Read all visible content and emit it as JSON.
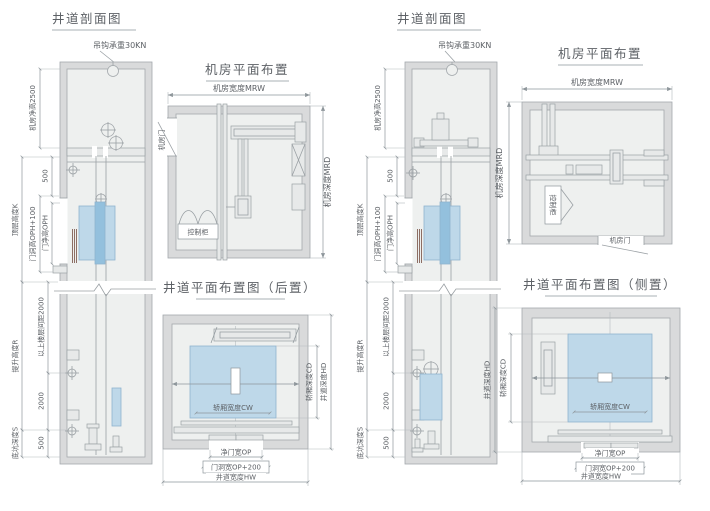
{
  "colors": {
    "line": "#9aa0a4",
    "wall_fill": "#d9dadb",
    "inner_fill": "#eef0ef",
    "car_fill": "#bed8e9",
    "car_band": "#93c0dd",
    "text": "#5d6166",
    "door_stripe": "#8d6e64"
  },
  "panels": {
    "section_left": {
      "title": "井道剖面图",
      "hook_label": "吊钩承重30KN",
      "machine_room_clear_height": "机房净高2500",
      "dim_500_top": "500",
      "door_opening_height": "门洞高OPH+100",
      "door_clear_height": "门净高OPH",
      "top_floor_height": "顶层高度K",
      "travel_height": "提升高度R",
      "upper_floor_spacing": "以上楼层间距2000",
      "dim_2000": "2000",
      "dim_500_bottom": "500",
      "pit_depth": "底坑深度S"
    },
    "machine_plan_left": {
      "title": "机房平面布置",
      "machine_room_width": "机房宽度MRW",
      "machine_room_depth": "机房深度MRD",
      "machine_room_door": "机房门",
      "control_cabinet": "控制柜"
    },
    "shaft_plan_rear": {
      "title": "井道平面布置图（后置）",
      "car_width": "轿厢宽度CW",
      "car_depth": "轿厢深度CD",
      "shaft_depth": "井道深度HD",
      "door_clear_width": "净门宽OP",
      "door_opening_width": "门洞宽OP+200",
      "shaft_width": "井道宽度HW"
    },
    "section_right": {
      "title": "井道剖面图",
      "hook_label": "吊钩承重30KN",
      "machine_room_clear_height": "机房净高2500",
      "dim_500_top": "500",
      "door_opening_height": "门洞高OPH+100",
      "door_clear_height": "门净高OPH",
      "top_floor_height": "顶层高度K",
      "travel_height": "提升高度R",
      "upper_floor_spacing": "以上楼层间距2000",
      "dim_2000": "2000",
      "dim_500_bottom": "500",
      "pit_depth": "底坑深度S"
    },
    "machine_plan_right": {
      "title": "机房平面布置",
      "machine_room_width": "机房宽度MRW",
      "machine_room_depth": "机房深度MRD",
      "machine_room_door": "机房门",
      "control_cabinet": "控制柜"
    },
    "shaft_plan_side": {
      "title": "井道平面布置图（侧置）",
      "car_width": "轿厢宽度CW",
      "car_depth": "轿厢深度CD",
      "shaft_depth": "井道深度HD",
      "door_clear_width": "净门宽OP",
      "door_opening_width": "门洞宽OP+200",
      "shaft_width": "井道宽度HW"
    }
  }
}
